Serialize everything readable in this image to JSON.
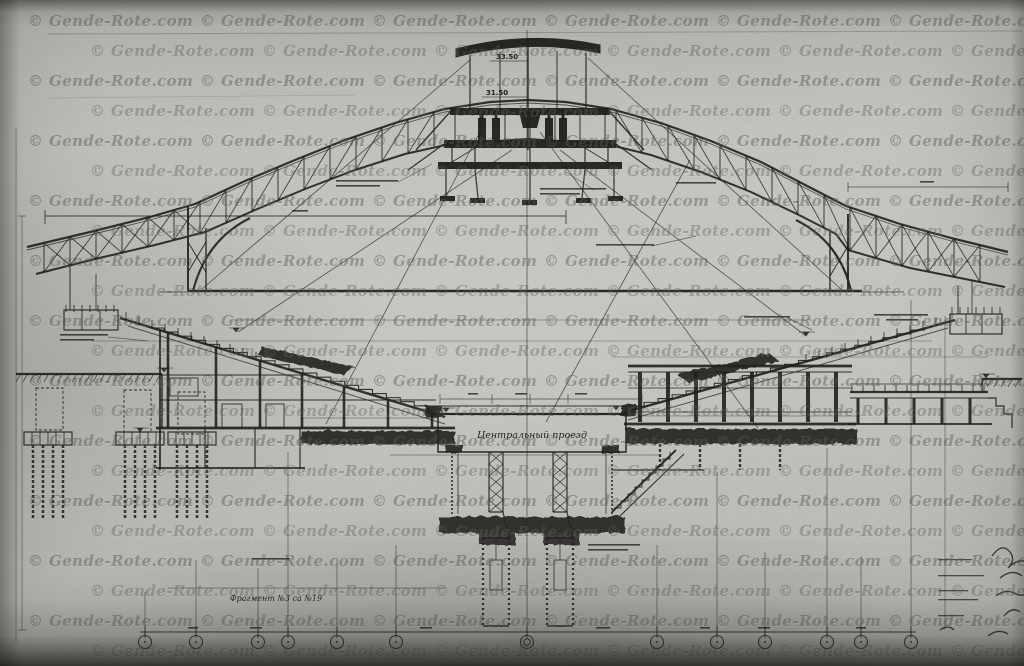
{
  "watermark": {
    "text": "© Gende-Rote.com"
  },
  "drawing": {
    "labels": {
      "elevation_top": "33.50",
      "elevation_mid": "31.50",
      "central_hall": "Центральный проезд",
      "fragment_note": "Фрагмент №3 са №19"
    }
  },
  "colors": {
    "paper": "#c2c2be",
    "ink": "#23211e",
    "watermark": "#3a3834"
  }
}
